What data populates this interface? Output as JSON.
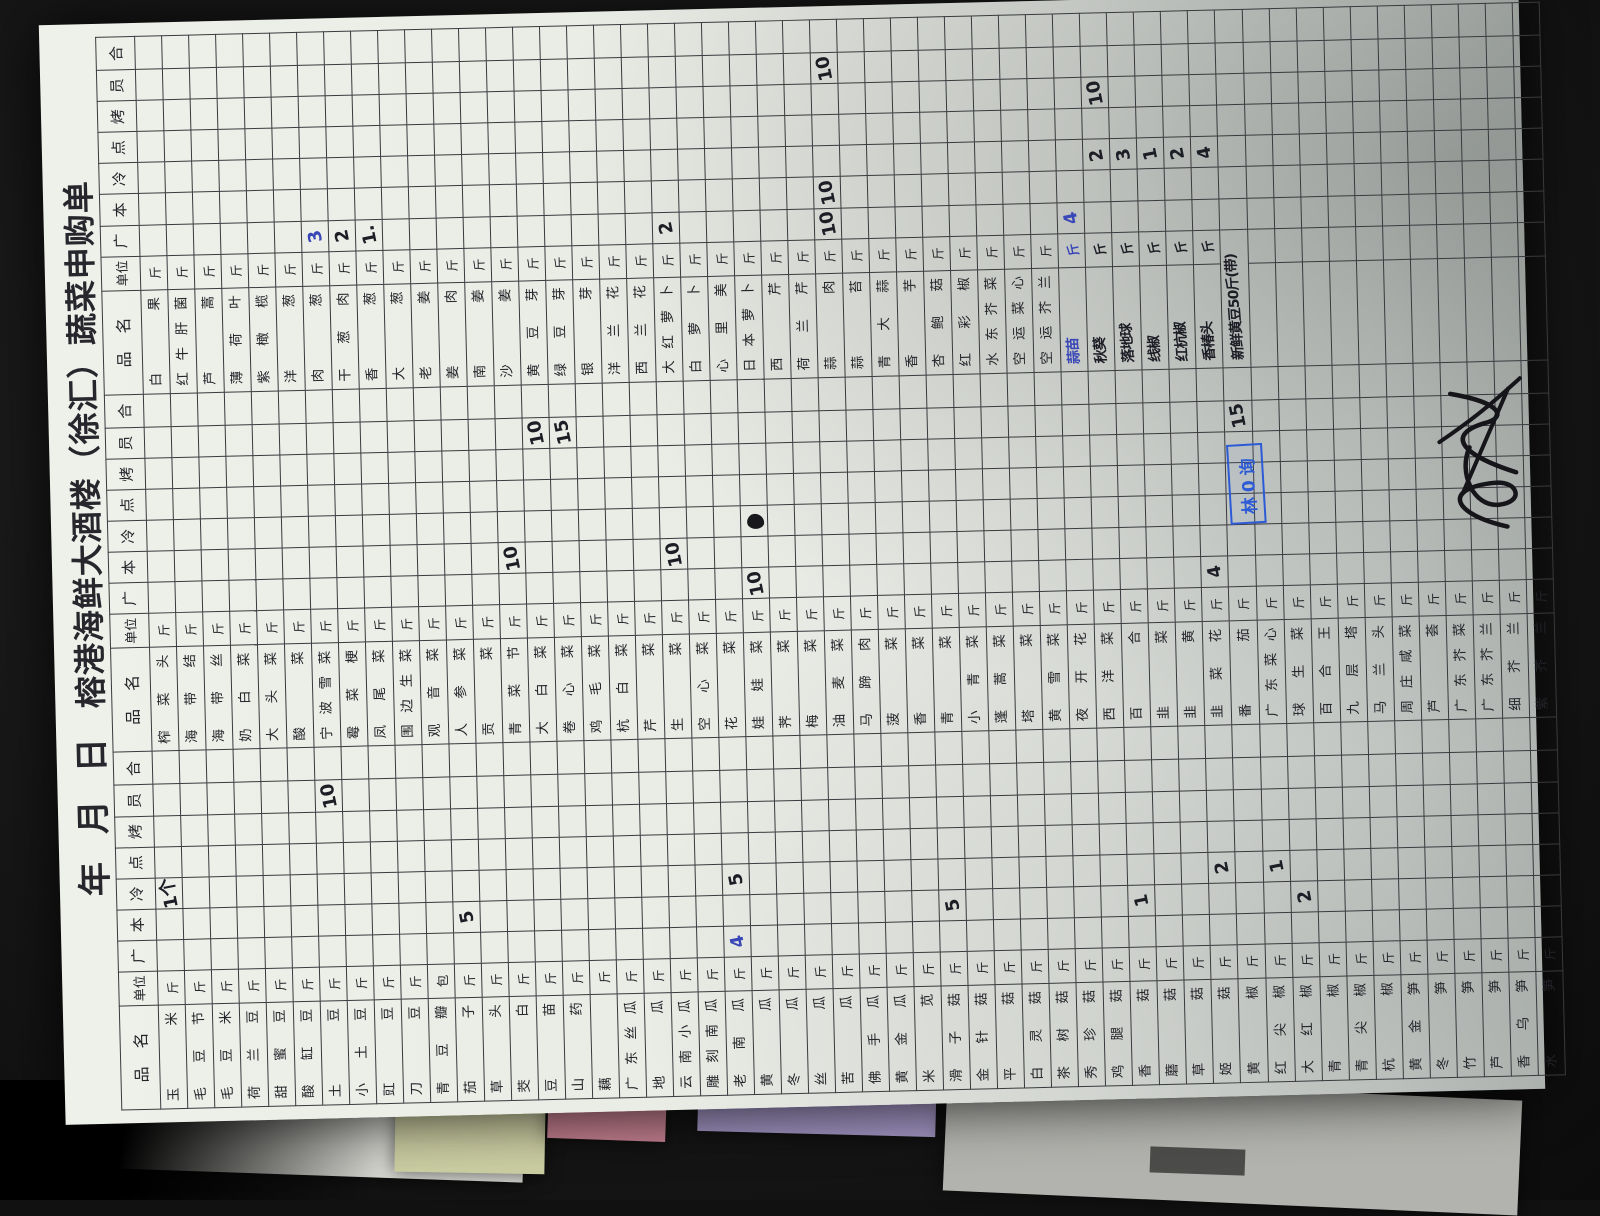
{
  "photo": {
    "background_color": "#1a1a1a",
    "paper_color": "#e9ebe5",
    "grid_color": "#3a3a3e",
    "ink_black": "#1d1d26",
    "ink_blue": "#3947b7",
    "stamp_blue": "#2d5bd6",
    "under_sheets": [
      {
        "name": "white-under-sheet",
        "color": "#d6d7d1",
        "x": 85,
        "y": 1040,
        "w": 440,
        "h": 135,
        "rot": 2
      },
      {
        "name": "yellow-under-sheet",
        "color": "#cdcfa4",
        "x": 395,
        "y": 1098,
        "w": 150,
        "h": 75,
        "rot": 1
      },
      {
        "name": "pink-under-sheet",
        "color": "#c47f90",
        "x": 548,
        "y": 1090,
        "w": 118,
        "h": 50,
        "rot": 2
      },
      {
        "name": "purple-under-sheet",
        "color": "#a093c1",
        "x": 698,
        "y": 1076,
        "w": 238,
        "h": 58,
        "rot": 1.5
      },
      {
        "name": "gray-under-sheet",
        "color": "#b2b3ae",
        "x": 945,
        "y": 1088,
        "w": 575,
        "h": 115,
        "rot": 2.5
      }
    ]
  },
  "document": {
    "title_year": "年",
    "title_month": "月",
    "title_day": "日",
    "title_name": "榕港海鲜大酒楼（徐汇）蔬菜申购单",
    "header": {
      "name": "品名",
      "unit": "单位",
      "depts": [
        "广",
        "本",
        "冷",
        "点",
        "烤",
        "员"
      ],
      "total": "合"
    },
    "rows_per_group": 52,
    "default_unit": "斤",
    "groups": [
      {
        "items": [
          "玉米",
          "毛豆节",
          "毛豆米",
          "荷兰豆",
          "甜蜜豆",
          "酸缸豆",
          "土豆",
          "小土豆",
          "豇豆",
          "刀豆",
          {
            "n": "青豆瓣",
            "u": "包"
          },
          "茄子",
          "草头",
          "茭白",
          "豆苗",
          "山药",
          "藕",
          "广东丝瓜",
          "地瓜",
          "云南小瓜",
          "雕刻南瓜",
          "老南瓜",
          "黄瓜",
          "冬瓜",
          "丝瓜",
          "苦瓜",
          "佛手瓜",
          "黄金瓜",
          "米苋",
          "滑子菇",
          "金针菇",
          "平菇",
          "白灵菇",
          "茶树菇",
          "秀珍菇",
          "鸡腿菇",
          "香菇",
          "蘑菇",
          "草菇",
          "姬菇",
          "黄椒",
          "红尖椒",
          "大红椒",
          "青椒",
          "青尖椒",
          "杭椒",
          "黄金笋",
          "冬笋",
          "竹笋",
          "芦笋",
          "香乌笋",
          "水笋"
        ],
        "marks": [
          {
            "row": 0,
            "col": "冷",
            "text": "1个"
          },
          {
            "row": 6,
            "col": "员",
            "text": "10"
          },
          {
            "row": 11,
            "col": "本",
            "text": "5"
          },
          {
            "row": 21,
            "col": "冷",
            "text": "5"
          },
          {
            "row": 21,
            "col": "广",
            "text": "4",
            "ink": "blue"
          },
          {
            "row": 29,
            "col": "本",
            "text": "5"
          },
          {
            "row": 36,
            "col": "本",
            "text": "1"
          },
          {
            "row": 39,
            "col": "冷",
            "text": "2"
          },
          {
            "row": 41,
            "col": "冷",
            "text": "1"
          },
          {
            "row": 42,
            "col": "本",
            "text": "2"
          }
        ]
      },
      {
        "items": [
          "榨菜头",
          "海带结",
          "海带丝",
          "奶白菜",
          "大头菜",
          "酸菜",
          "宁波雪菜",
          "霉菜梗",
          "凤尾菜",
          "围边生菜",
          "观音菜",
          "人参菜",
          "贡菜",
          "青菜节",
          "大白菜",
          "卷心菜",
          "鸡毛菜",
          "杭白菜",
          "芹菜",
          "生菜",
          "空心菜",
          "花菜",
          "娃娃菜",
          "荠菜",
          "梅菜",
          "油麦菜",
          "马蹄肉",
          "菠菜",
          "香菜",
          "青菜",
          "小青菜",
          "蓬蒿菜",
          "塔菜",
          "黄雪菜",
          "夜开花",
          "西洋菜",
          "百合",
          "韭菜",
          "韭黄",
          "韭菜花",
          "番茄",
          "广东菜心",
          "球生菜",
          "百合王",
          "九层塔",
          "马兰头",
          "周庄咸菜",
          "芦荟",
          "广东芥菜",
          "广东芥兰",
          "细芥兰",
          "紫芥兰"
        ],
        "marks": [
          {
            "row": 13,
            "col": "本",
            "text": "10"
          },
          {
            "row": 14,
            "col": "员",
            "text": "10"
          },
          {
            "row": 15,
            "col": "员",
            "text": "15"
          },
          {
            "row": 19,
            "col": "本",
            "text": "10"
          },
          {
            "row": 22,
            "col": "冷",
            "blob": true
          },
          {
            "row": 22,
            "col": "广",
            "text": "10"
          },
          {
            "row": 39,
            "col": "广",
            "text": "4"
          },
          {
            "row": 40,
            "col": "员",
            "text": "15"
          }
        ]
      },
      {
        "items": [
          "白果",
          "红牛肝菌",
          "芦蒿",
          "薄荷叶",
          "紫橄榄",
          "洋葱",
          "肉葱",
          "干葱肉",
          "香葱",
          "大葱",
          "老姜",
          "姜肉",
          "南姜",
          "沙姜",
          "黄豆芽",
          "绿豆芽",
          "银芽",
          "洋兰花",
          "西兰花",
          "大红萝卜",
          "白萝卜",
          "心里美",
          "日本萝卜",
          "西芹",
          "荷兰芹",
          "蒜肉",
          "蒜苔",
          "青大蒜",
          "香芋",
          "杏鲍菇",
          "红彩椒",
          "水东芥菜",
          "空运菜心",
          "空运芥兰",
          {
            "n": "蒜苗",
            "hw": true,
            "ink": "blue",
            "uhw": true
          },
          {
            "n": "秋葵",
            "hw": true,
            "uhw": true
          },
          {
            "n": "落地球",
            "hw": true,
            "uhw": true
          },
          {
            "n": "线椒",
            "hw": true,
            "uhw": true
          },
          {
            "n": "红杭椒",
            "hw": true,
            "uhw": true
          },
          {
            "n": "香椿头",
            "hw": true,
            "uhw": true
          },
          {
            "n": "新鲜黄豆50斤(带)",
            "hw": true,
            "u": ""
          }
        ],
        "marks": [
          {
            "row": 6,
            "col": "广",
            "text": "3",
            "ink": "blue"
          },
          {
            "row": 7,
            "col": "广",
            "text": "2"
          },
          {
            "row": 8,
            "col": "广",
            "text": "1."
          },
          {
            "row": 19,
            "col": "广",
            "text": "2"
          },
          {
            "row": 25,
            "col": "员",
            "text": "10"
          },
          {
            "row": 25,
            "col": "本",
            "text": "10"
          },
          {
            "row": 25,
            "col": "广",
            "text": "10"
          },
          {
            "row": 34,
            "col": "广",
            "text": "4",
            "ink": "blue"
          },
          {
            "row": 35,
            "col": "烤",
            "text": "10"
          },
          {
            "row": 35,
            "col": "冷",
            "text": "2"
          },
          {
            "row": 36,
            "col": "冷",
            "text": "3"
          },
          {
            "row": 37,
            "col": "冷",
            "text": "1"
          },
          {
            "row": 38,
            "col": "冷",
            "text": "2"
          },
          {
            "row": 39,
            "col": "冷",
            "text": "4"
          }
        ]
      }
    ],
    "stamp": {
      "text": "林0询"
    }
  }
}
